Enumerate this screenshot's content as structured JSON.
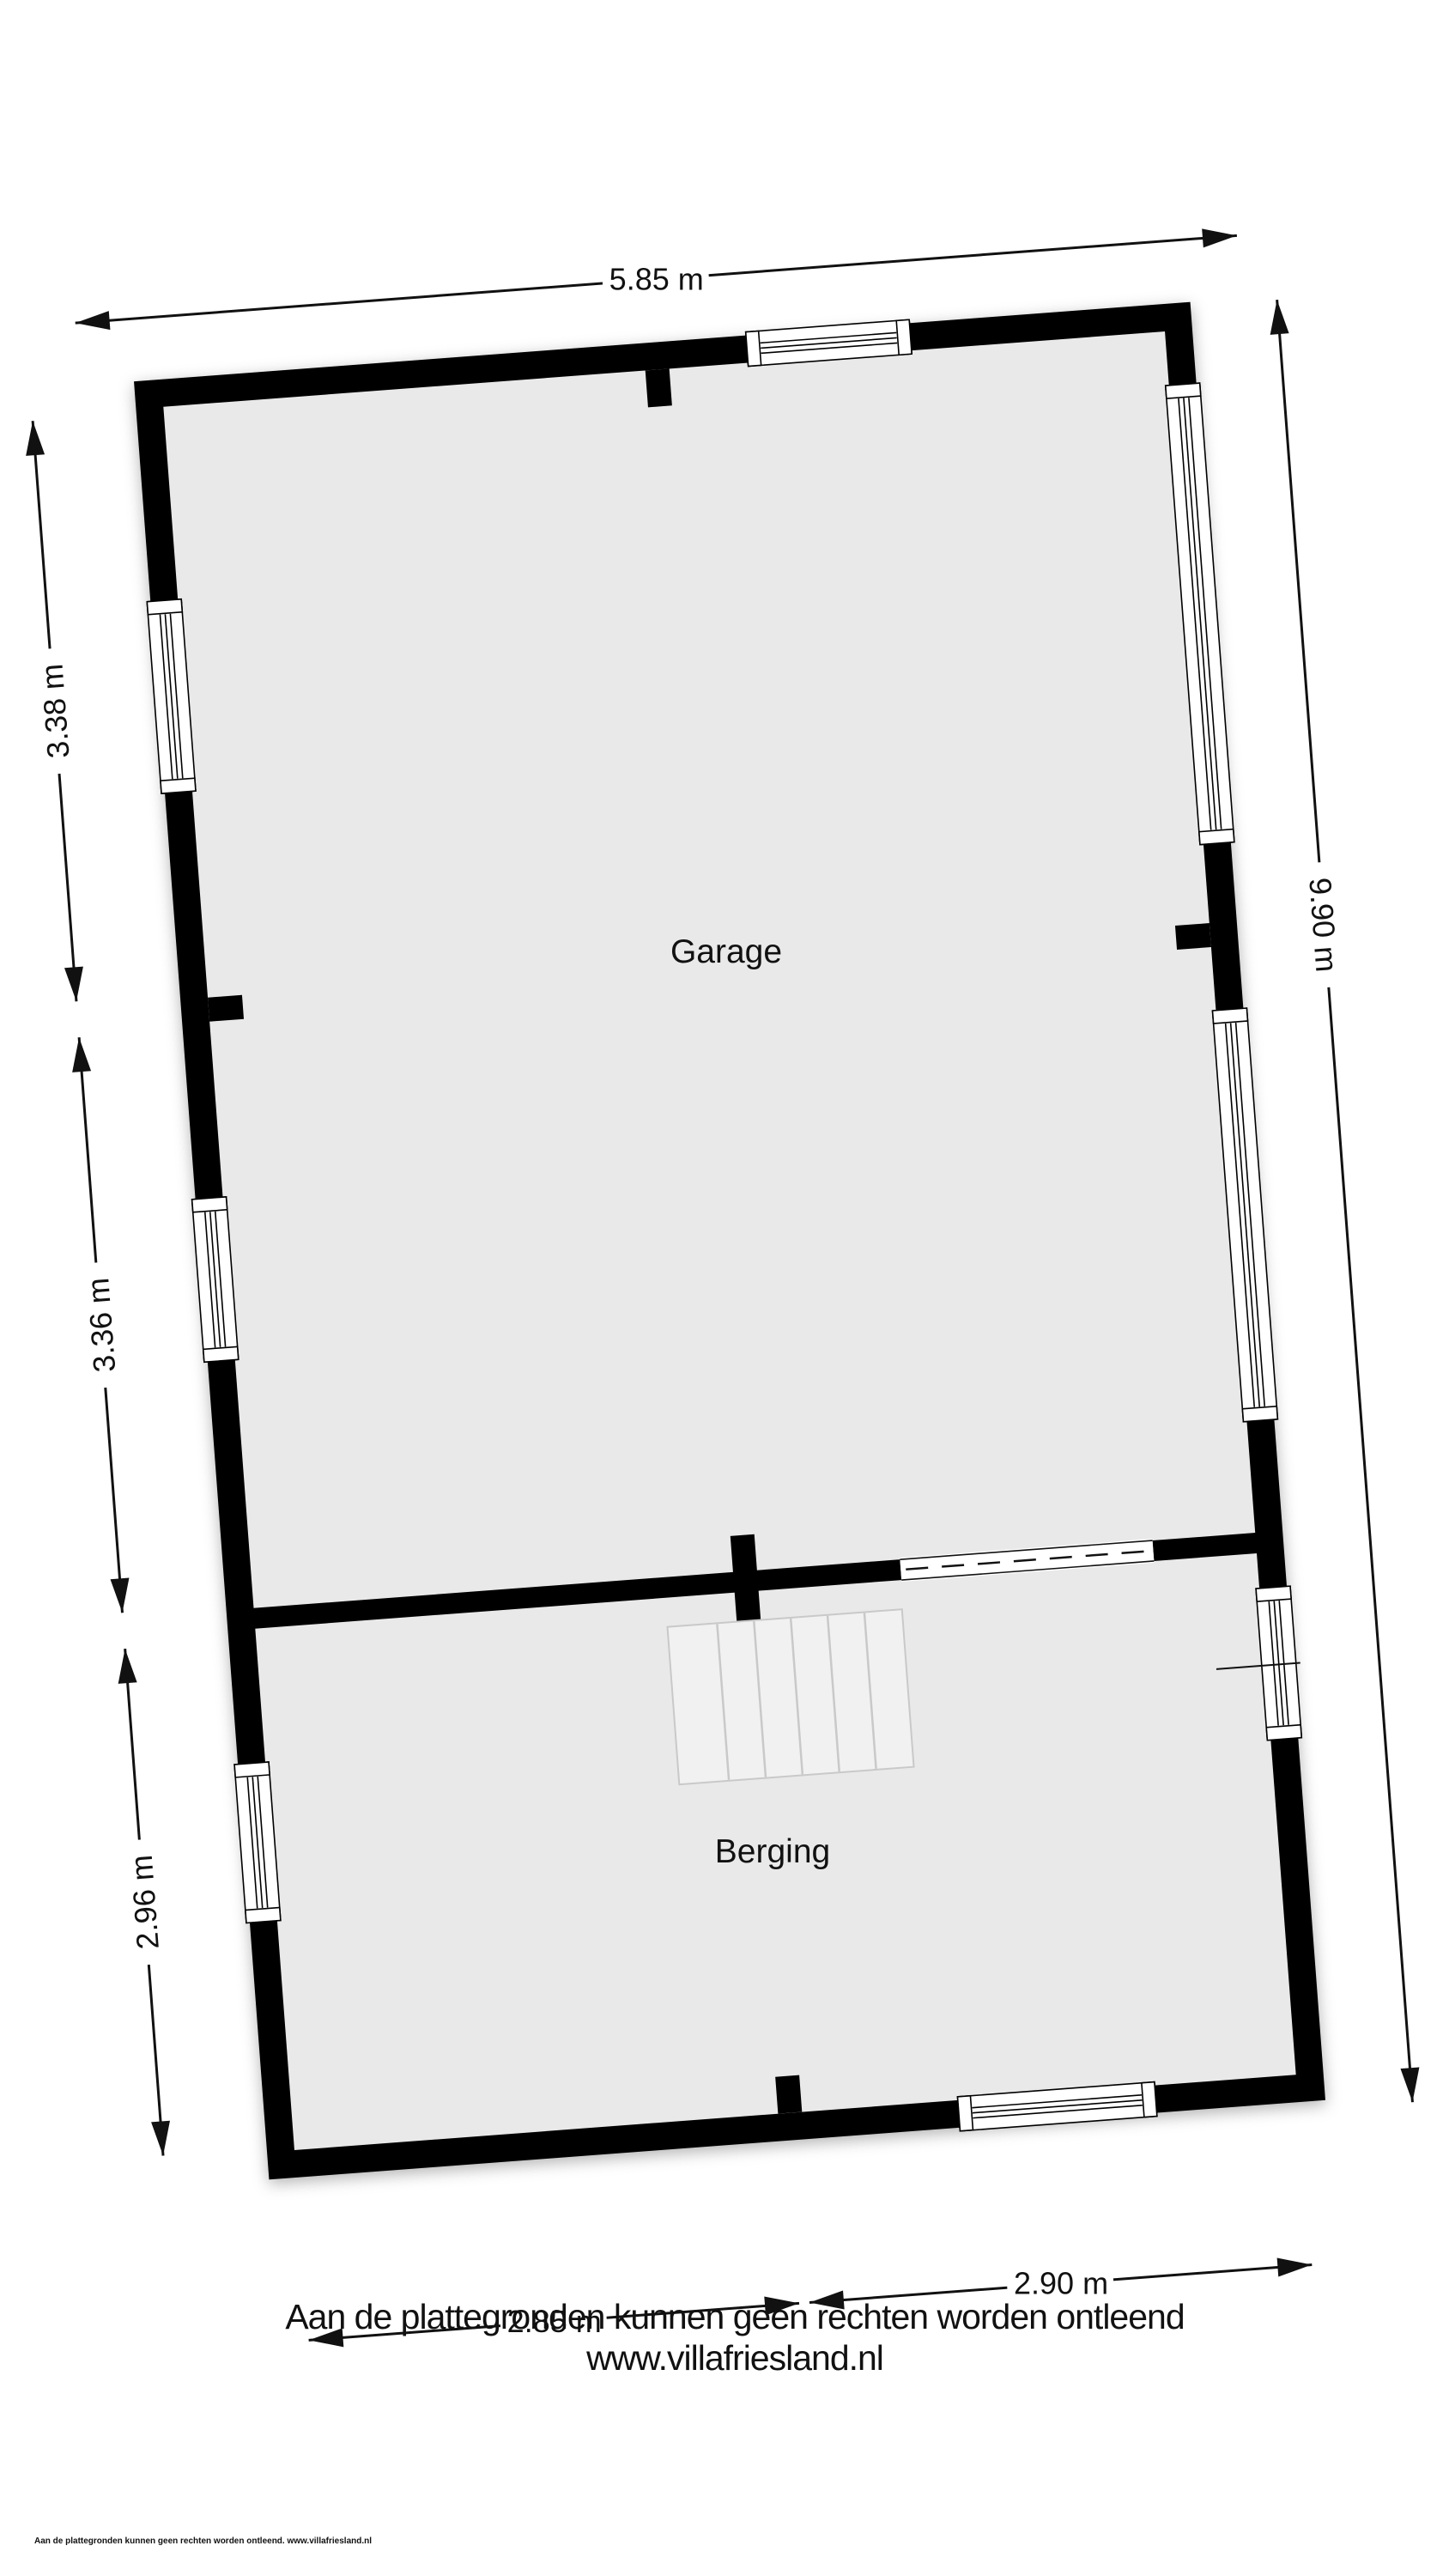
{
  "floorplan": {
    "rooms": {
      "garage": "Garage",
      "berging": "Berging"
    },
    "dims": {
      "top": "5.85 m",
      "left_upper": "3.38 m",
      "left_middle": "3.36 m",
      "left_lower": "2.96 m",
      "right": "9.90 m",
      "bottom_left": "2.85 m",
      "bottom_right": "2.90 m"
    },
    "colors": {
      "wall": "#000000",
      "floor": "#e9e9e9",
      "stairs": "#f1f1f1",
      "background": "#ffffff"
    },
    "stairs_treads": 6
  },
  "footer": {
    "disclaimer": "Aan de plattegronden kunnen geen rechten worden ontleend",
    "website": "www.villafriesland.nl",
    "fine_print": "Aan de plattegronden kunnen geen rechten worden ontleend. www.villafriesland.nl"
  }
}
